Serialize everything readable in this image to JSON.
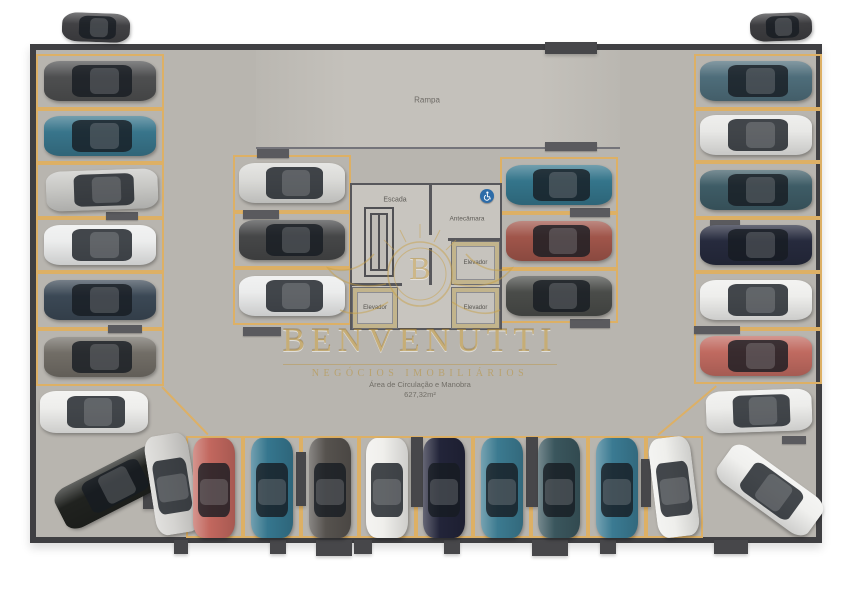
{
  "scene": {
    "labels": {
      "ramp": "Rampa",
      "stairs": "Escada",
      "antechamber": "Antecâmara",
      "elevator1": "Elevador",
      "elevator2": "Elevador",
      "elevator3": "Elevador",
      "area_caption": "Área de Circulação e Manobra",
      "area_value": "627,32m²"
    },
    "watermark": {
      "monogram": "B",
      "brand": "BENVENUTTI",
      "tagline": "NEGÓCIOS IMOBILIÁRIOS",
      "color": "#ba9440"
    },
    "icons": {
      "accessible": "wheelchair-icon"
    },
    "colors": {
      "floor": "#b8b5af",
      "ramp_floor": "#c4c1bb",
      "wall": "#3f3f42",
      "stall_line": "#ddb065",
      "core_fill": "#c8c5bf",
      "elevator_frame": "#c2b48c",
      "accessible_badge": "#2d6ca8"
    }
  },
  "parking": {
    "stalls": [
      {
        "x": 36,
        "y": 54,
        "w": 128,
        "h": 55
      },
      {
        "x": 36,
        "y": 109,
        "w": 128,
        "h": 54
      },
      {
        "x": 36,
        "y": 163,
        "w": 128,
        "h": 55
      },
      {
        "x": 36,
        "y": 218,
        "w": 128,
        "h": 54
      },
      {
        "x": 36,
        "y": 272,
        "w": 128,
        "h": 57
      },
      {
        "x": 36,
        "y": 329,
        "w": 128,
        "h": 57
      },
      {
        "x": 694,
        "y": 54,
        "w": 128,
        "h": 55
      },
      {
        "x": 694,
        "y": 109,
        "w": 128,
        "h": 53
      },
      {
        "x": 694,
        "y": 162,
        "w": 128,
        "h": 56
      },
      {
        "x": 694,
        "y": 218,
        "w": 128,
        "h": 54
      },
      {
        "x": 694,
        "y": 272,
        "w": 128,
        "h": 57
      },
      {
        "x": 694,
        "y": 329,
        "w": 128,
        "h": 55
      },
      {
        "x": 186,
        "y": 436,
        "w": 57,
        "h": 102
      },
      {
        "x": 243,
        "y": 436,
        "w": 58,
        "h": 102
      },
      {
        "x": 301,
        "y": 436,
        "w": 58,
        "h": 102
      },
      {
        "x": 359,
        "y": 436,
        "w": 57,
        "h": 102
      },
      {
        "x": 416,
        "y": 436,
        "w": 57,
        "h": 102
      },
      {
        "x": 473,
        "y": 436,
        "w": 58,
        "h": 102
      },
      {
        "x": 531,
        "y": 436,
        "w": 57,
        "h": 102
      },
      {
        "x": 588,
        "y": 436,
        "w": 58,
        "h": 102
      },
      {
        "x": 646,
        "y": 436,
        "w": 57,
        "h": 102
      },
      {
        "x": 233,
        "y": 155,
        "w": 118,
        "h": 57
      },
      {
        "x": 233,
        "y": 212,
        "w": 118,
        "h": 56
      },
      {
        "x": 233,
        "y": 268,
        "w": 118,
        "h": 57
      },
      {
        "x": 500,
        "y": 157,
        "w": 118,
        "h": 56
      },
      {
        "x": 500,
        "y": 213,
        "w": 118,
        "h": 56
      },
      {
        "x": 500,
        "y": 269,
        "w": 118,
        "h": 54
      }
    ],
    "diag_lines": [
      {
        "x": 162,
        "y": 386,
        "len": 66,
        "a": 46
      },
      {
        "x": 658,
        "y": 434,
        "len": 76,
        "a": -40
      }
    ],
    "curbs": [
      {
        "x": 257,
        "y": 149,
        "w": 32,
        "h": 9
      },
      {
        "x": 243,
        "y": 210,
        "w": 36,
        "h": 9
      },
      {
        "x": 243,
        "y": 327,
        "w": 38,
        "h": 9
      },
      {
        "x": 570,
        "y": 208,
        "w": 40,
        "h": 9
      },
      {
        "x": 570,
        "y": 319,
        "w": 40,
        "h": 9
      },
      {
        "x": 106,
        "y": 212,
        "w": 32,
        "h": 8
      },
      {
        "x": 108,
        "y": 325,
        "w": 34,
        "h": 8
      },
      {
        "x": 710,
        "y": 220,
        "w": 30,
        "h": 8
      },
      {
        "x": 694,
        "y": 326,
        "w": 46,
        "h": 8
      },
      {
        "x": 782,
        "y": 436,
        "w": 24,
        "h": 8
      },
      {
        "x": 545,
        "y": 142,
        "w": 52,
        "h": 9
      }
    ],
    "pillars": [
      {
        "x": 296,
        "y": 452,
        "w": 10,
        "h": 54
      },
      {
        "x": 411,
        "y": 437,
        "w": 12,
        "h": 70
      },
      {
        "x": 526,
        "y": 437,
        "w": 12,
        "h": 70
      },
      {
        "x": 641,
        "y": 459,
        "w": 10,
        "h": 48
      },
      {
        "x": 143,
        "y": 476,
        "w": 12,
        "h": 33
      },
      {
        "x": 545,
        "y": 42,
        "w": 52,
        "h": 12
      },
      {
        "x": 174,
        "y": 540,
        "w": 14,
        "h": 14
      },
      {
        "x": 270,
        "y": 540,
        "w": 16,
        "h": 14
      },
      {
        "x": 316,
        "y": 540,
        "w": 36,
        "h": 16
      },
      {
        "x": 354,
        "y": 540,
        "w": 18,
        "h": 14
      },
      {
        "x": 444,
        "y": 540,
        "w": 16,
        "h": 14
      },
      {
        "x": 532,
        "y": 540,
        "w": 36,
        "h": 16
      },
      {
        "x": 600,
        "y": 540,
        "w": 16,
        "h": 14
      },
      {
        "x": 714,
        "y": 540,
        "w": 34,
        "h": 14
      }
    ],
    "cars": [
      {
        "id": "upper-left",
        "x": 62,
        "y": 13,
        "w": 68,
        "h": 29,
        "o": "h",
        "a": 2,
        "c": "#414144"
      },
      {
        "id": "upper-right",
        "x": 750,
        "y": 13,
        "w": 62,
        "h": 28,
        "o": "h",
        "a": -2,
        "c": "#3d3d40"
      },
      {
        "id": "left-1",
        "x": 44,
        "y": 61,
        "w": 112,
        "h": 40,
        "o": "h",
        "a": 0,
        "c": "#4e4f50"
      },
      {
        "id": "left-2",
        "x": 44,
        "y": 116,
        "w": 112,
        "h": 40,
        "o": "h",
        "a": 0,
        "c": "#38758b"
      },
      {
        "id": "left-3",
        "x": 46,
        "y": 170,
        "w": 112,
        "h": 40,
        "o": "h",
        "a": -2,
        "c": "#c9c9c6"
      },
      {
        "id": "left-4",
        "x": 44,
        "y": 225,
        "w": 112,
        "h": 40,
        "o": "h",
        "a": 0,
        "c": "#eceded"
      },
      {
        "id": "left-5",
        "x": 44,
        "y": 280,
        "w": 112,
        "h": 40,
        "o": "h",
        "a": 0,
        "c": "#3b4855"
      },
      {
        "id": "left-6",
        "x": 44,
        "y": 337,
        "w": 112,
        "h": 40,
        "o": "h",
        "a": 0,
        "c": "#716d66"
      },
      {
        "id": "left-corner-white",
        "x": 40,
        "y": 391,
        "w": 108,
        "h": 42,
        "o": "h",
        "a": 0,
        "c": "#eeeeec"
      },
      {
        "id": "left-corner-black",
        "x": 54,
        "y": 465,
        "w": 118,
        "h": 44,
        "o": "h",
        "a": -27,
        "c": "#20221f"
      },
      {
        "id": "right-1",
        "x": 700,
        "y": 61,
        "w": 112,
        "h": 40,
        "o": "h",
        "a": 0,
        "c": "#4e6d7a"
      },
      {
        "id": "right-2",
        "x": 700,
        "y": 115,
        "w": 112,
        "h": 40,
        "o": "h",
        "a": 0,
        "c": "#e8e8e6"
      },
      {
        "id": "right-3",
        "x": 700,
        "y": 170,
        "w": 112,
        "h": 40,
        "o": "h",
        "a": 0,
        "c": "#3e5c66"
      },
      {
        "id": "right-4",
        "x": 700,
        "y": 225,
        "w": 112,
        "h": 40,
        "o": "h",
        "a": 0,
        "c": "#262a3d"
      },
      {
        "id": "right-5",
        "x": 700,
        "y": 280,
        "w": 112,
        "h": 40,
        "o": "h",
        "a": 0,
        "c": "#eeeeec"
      },
      {
        "id": "right-6",
        "x": 700,
        "y": 336,
        "w": 112,
        "h": 40,
        "o": "h",
        "a": 0,
        "c": "#c06a60"
      },
      {
        "id": "right-corner-white",
        "x": 706,
        "y": 390,
        "w": 106,
        "h": 42,
        "o": "h",
        "a": -2,
        "c": "#ededeb"
      },
      {
        "id": "right-corner-diag",
        "x": 714,
        "y": 468,
        "w": 112,
        "h": 44,
        "o": "h",
        "a": 36,
        "c": "#f0f0ee"
      },
      {
        "id": "bottom-0-silver",
        "x": 150,
        "y": 434,
        "w": 44,
        "h": 100,
        "o": "v",
        "a": -9,
        "c": "#d5d4d1"
      },
      {
        "id": "bottom-1-red",
        "x": 193,
        "y": 438,
        "w": 42,
        "h": 100,
        "o": "v",
        "a": 0,
        "c": "#c2675e"
      },
      {
        "id": "bottom-2-teal",
        "x": 251,
        "y": 438,
        "w": 42,
        "h": 100,
        "o": "v",
        "a": 0,
        "c": "#35768e"
      },
      {
        "id": "bottom-3-gray",
        "x": 309,
        "y": 438,
        "w": 42,
        "h": 100,
        "o": "v",
        "a": 0,
        "c": "#56524e"
      },
      {
        "id": "bottom-4-white",
        "x": 366,
        "y": 438,
        "w": 42,
        "h": 100,
        "o": "v",
        "a": 0,
        "c": "#f0efec"
      },
      {
        "id": "bottom-5-navy",
        "x": 423,
        "y": 438,
        "w": 42,
        "h": 100,
        "o": "v",
        "a": 0,
        "c": "#222439"
      },
      {
        "id": "bottom-6-teal",
        "x": 481,
        "y": 438,
        "w": 42,
        "h": 100,
        "o": "v",
        "a": 0,
        "c": "#3b7a90"
      },
      {
        "id": "bottom-7-darkteal",
        "x": 538,
        "y": 438,
        "w": 42,
        "h": 100,
        "o": "v",
        "a": 0,
        "c": "#3a565d"
      },
      {
        "id": "bottom-8-teal",
        "x": 596,
        "y": 438,
        "w": 42,
        "h": 100,
        "o": "v",
        "a": 0,
        "c": "#3a7a92"
      },
      {
        "id": "bottom-9-white",
        "x": 653,
        "y": 437,
        "w": 42,
        "h": 100,
        "o": "v",
        "a": -7,
        "c": "#efefec"
      },
      {
        "id": "inner-left-1",
        "x": 239,
        "y": 163,
        "w": 106,
        "h": 40,
        "o": "h",
        "a": 0,
        "c": "#dbdbd8"
      },
      {
        "id": "inner-left-2",
        "x": 239,
        "y": 220,
        "w": 106,
        "h": 40,
        "o": "h",
        "a": 0,
        "c": "#464748"
      },
      {
        "id": "inner-left-3",
        "x": 239,
        "y": 276,
        "w": 106,
        "h": 40,
        "o": "h",
        "a": 0,
        "c": "#ebecec"
      },
      {
        "id": "inner-right-1",
        "x": 506,
        "y": 165,
        "w": 106,
        "h": 40,
        "o": "h",
        "a": 0,
        "c": "#34758b"
      },
      {
        "id": "inner-right-2",
        "x": 506,
        "y": 221,
        "w": 106,
        "h": 40,
        "o": "h",
        "a": 0,
        "c": "#a0554a"
      },
      {
        "id": "inner-right-3",
        "x": 506,
        "y": 276,
        "w": 106,
        "h": 40,
        "o": "h",
        "a": 0,
        "c": "#4a4c49"
      }
    ]
  }
}
